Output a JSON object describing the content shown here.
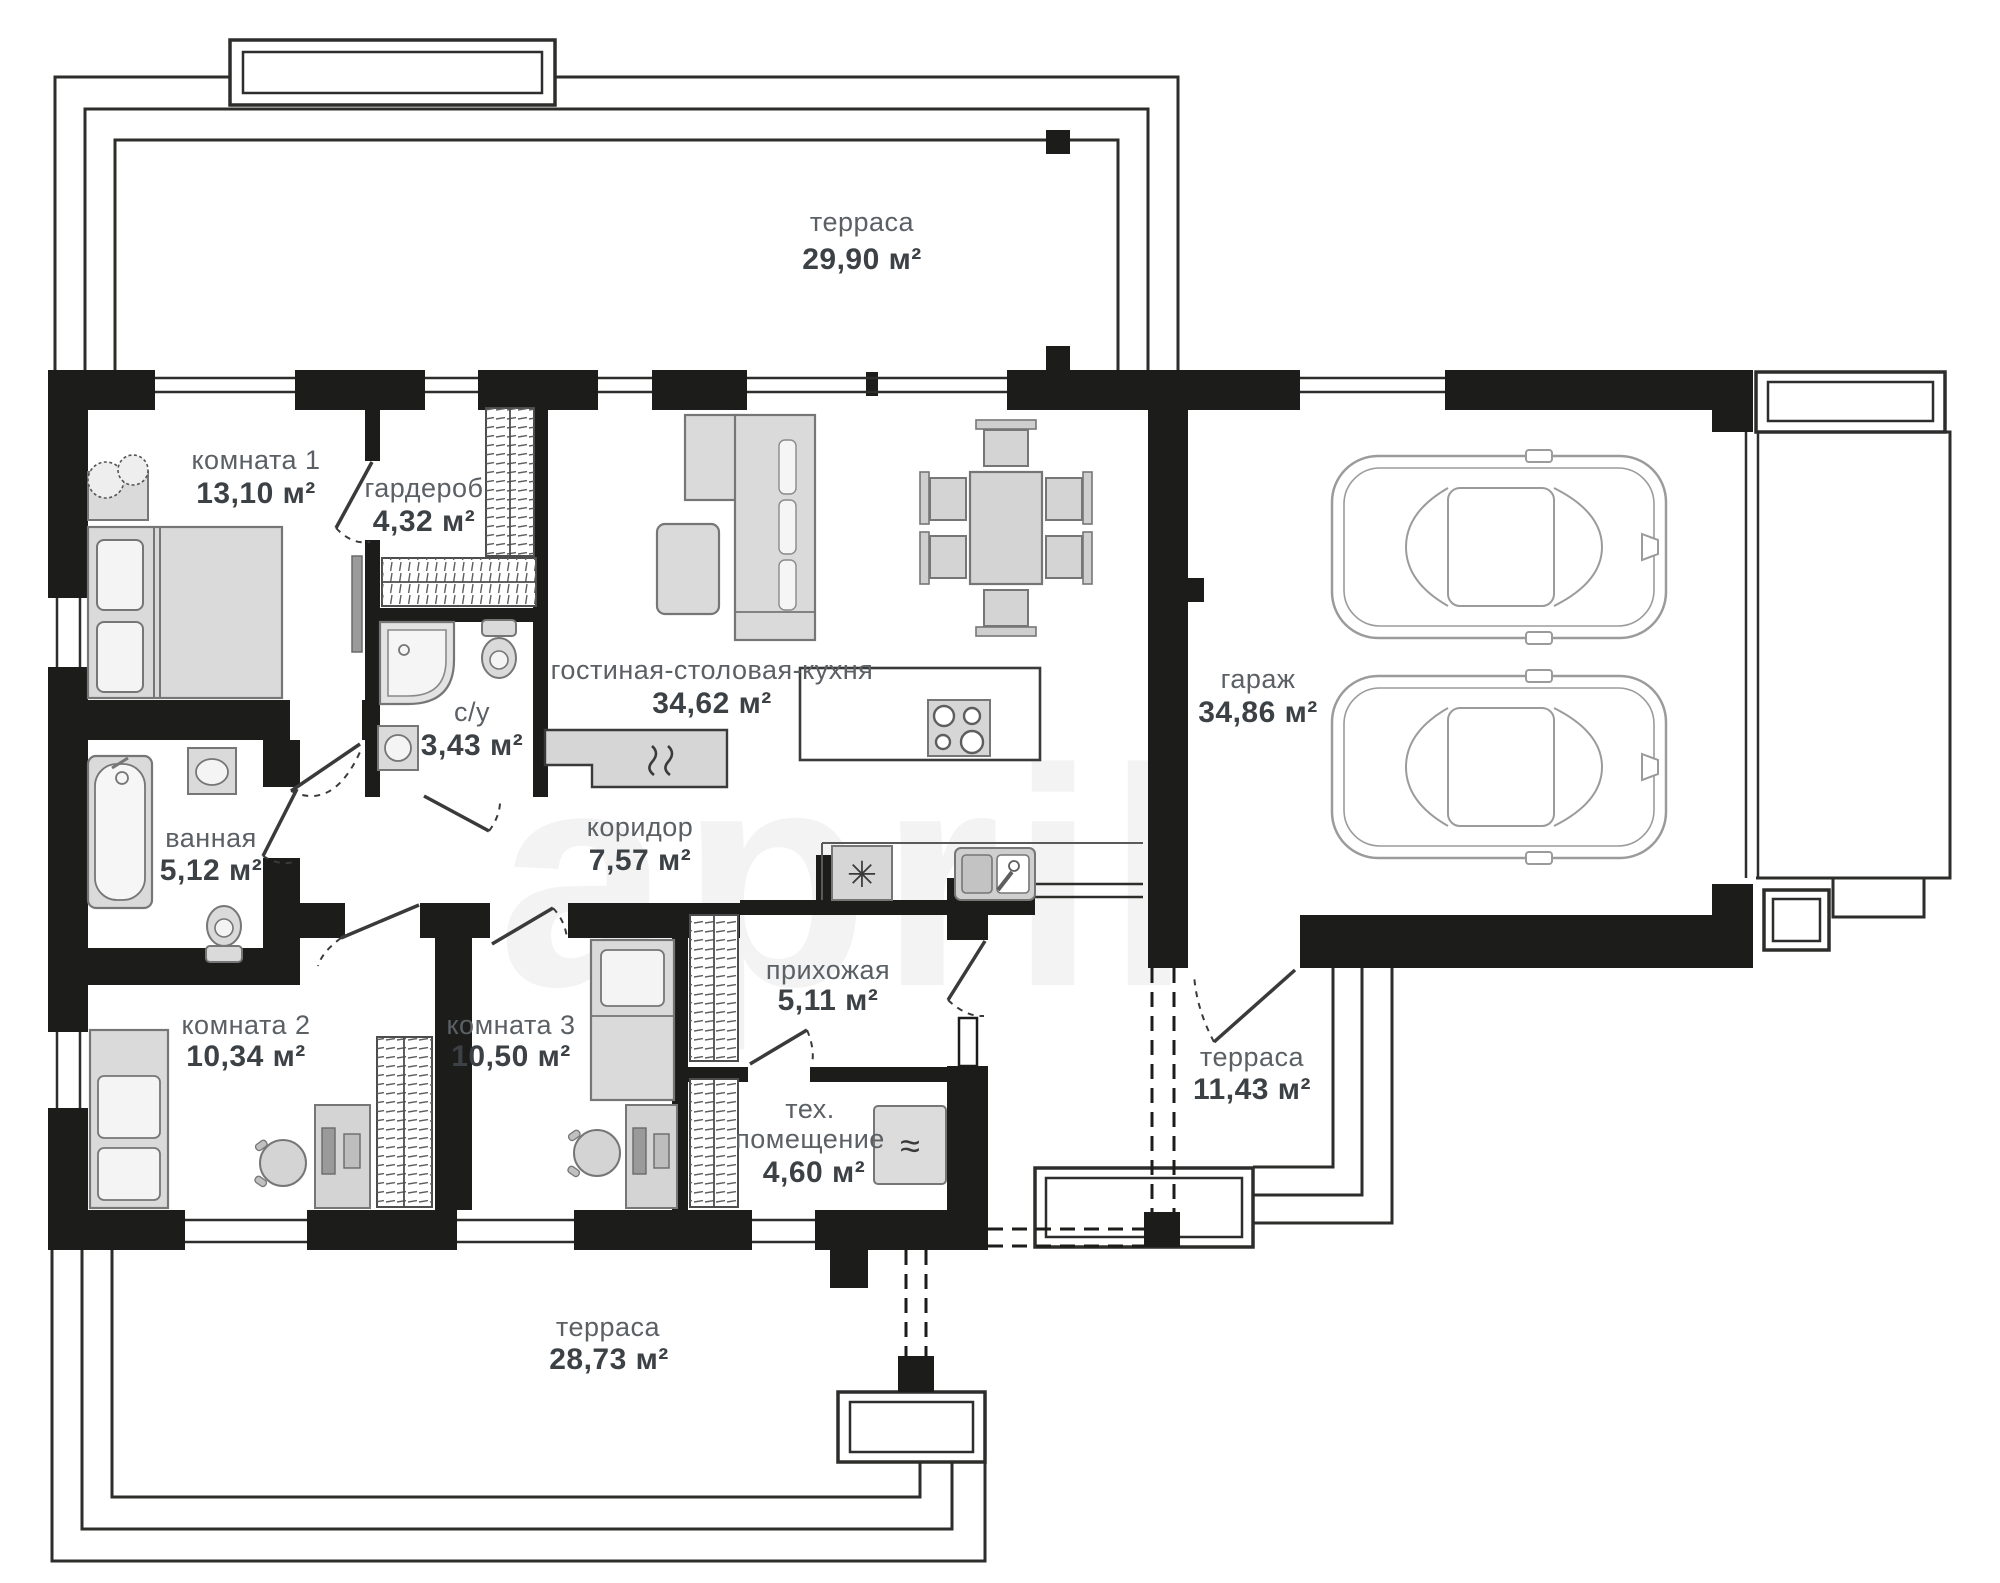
{
  "watermark": "april",
  "labels": {
    "terrace_top": {
      "name": "терраса",
      "area": "29,90 м²"
    },
    "room1": {
      "name": "комната 1",
      "area": "13,10 м²"
    },
    "wardrobe": {
      "name": "гардероб",
      "area": "4,32 м²"
    },
    "living": {
      "name": "гостиная-столовая-кухня",
      "area": "34,62 м²"
    },
    "garage": {
      "name": "гараж",
      "area": "34,86 м²"
    },
    "su": {
      "name": "с/у",
      "area": "3,43 м²"
    },
    "corridor": {
      "name": "коридор",
      "area": "7,57 м²"
    },
    "bathroom": {
      "name": "ванная",
      "area": "5,12 м²"
    },
    "hallway": {
      "name": "прихожая",
      "area": "5,11 м²"
    },
    "room2": {
      "name": "комната 2",
      "area": "10,34 м²"
    },
    "room3": {
      "name": "комната 3",
      "area": "10,50 м²"
    },
    "tech": {
      "name_line1": "тех.",
      "name_line2": "помещение",
      "area": "4,60 м²"
    },
    "terrace_right": {
      "name": "терраса",
      "area": "11,43 м²"
    },
    "terrace_bottom": {
      "name": "терраса",
      "area": "28,73 м²"
    }
  },
  "icons": {
    "fridge": "✳",
    "water_heater": "≈"
  },
  "colors": {
    "wall": "#1c1c1a",
    "outline": "#2d2d2b",
    "furniture_fill": "#dadada",
    "furniture_stroke": "#767676",
    "label_name": "#5b6065",
    "label_area": "#3c4145",
    "watermark": "#f3f3f3"
  }
}
